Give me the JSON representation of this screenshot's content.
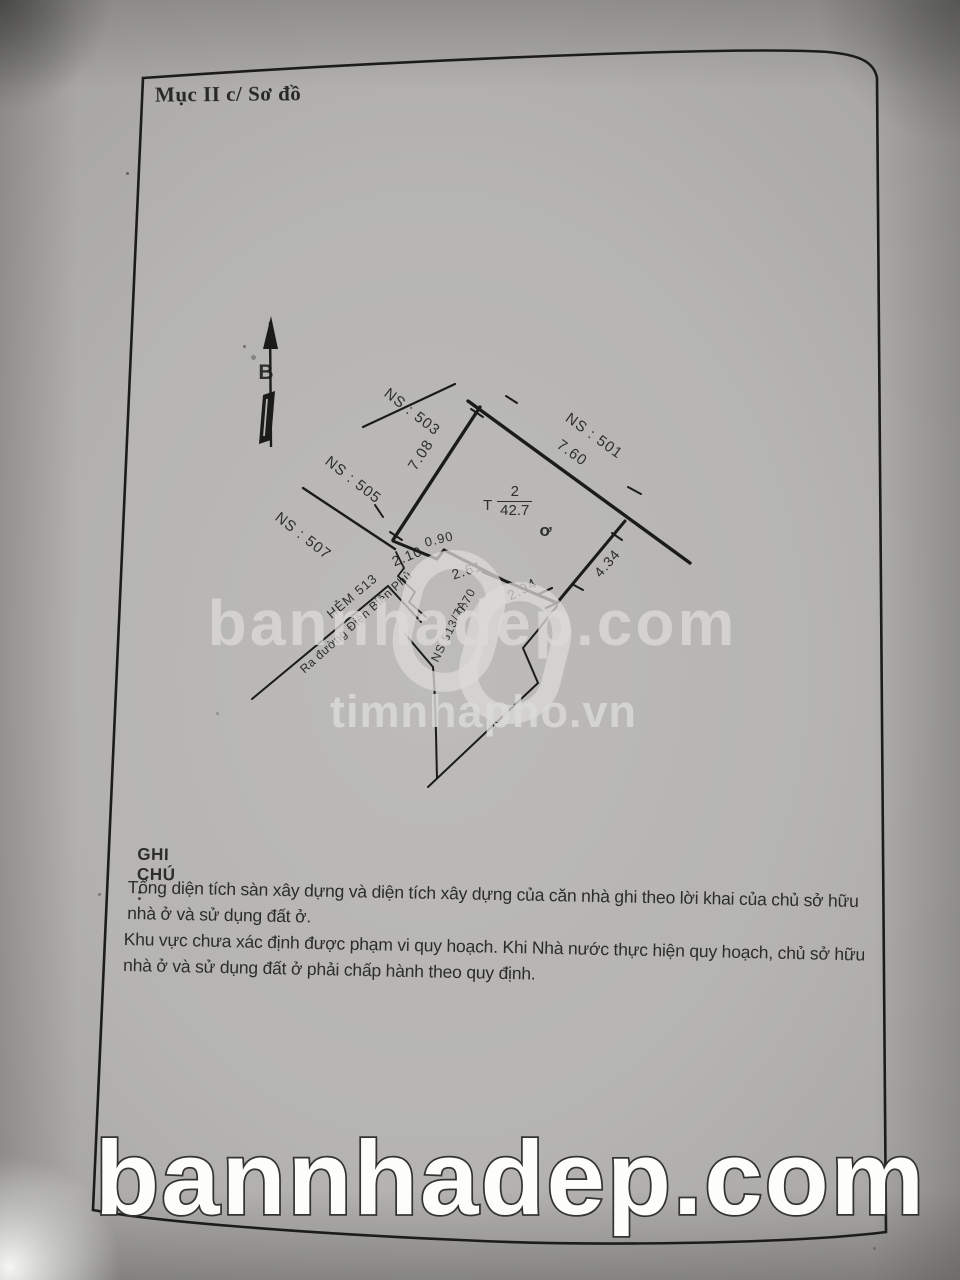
{
  "page": {
    "section_title": "Mục II c/ Sơ đồ",
    "compass_label": "B"
  },
  "sketch": {
    "parcels": {
      "p503": "NS : 503",
      "p505": "NS : 505",
      "p507": "NS : 507",
      "p501": "NS : 501"
    },
    "dims": {
      "d708": "7.08",
      "d760": "7.60",
      "d090": "0.90",
      "d210": "2.10",
      "d261": "2.61",
      "d294": "2.94",
      "d070": "0.70",
      "d434": "4.34"
    },
    "plot": {
      "prefix": "T",
      "floors": "2",
      "area": "42.7",
      "marker": "ơ"
    },
    "streets": {
      "hem": "HẺM 513",
      "ra_duong": "Ra đường Điện Biên Phủ",
      "ns_alley": "NS 513/7A"
    }
  },
  "notes": {
    "heading": "GHI CHÚ :",
    "paragraphs": [
      "Tổng diện tích sàn xây dựng và diện tích xây dựng của căn nhà ghi theo lời khai của chủ sở hữu nhà ở và sử dụng đất ở.",
      "Khu vực chưa xác định được phạm vi quy hoạch. Khi Nhà nước thực hiện quy hoạch, chủ sở hữu nhà ở và sử dụng đất ở phải chấp hành theo quy định."
    ]
  },
  "watermarks": {
    "center_text": "bannhadep.com",
    "center_sub": "timnhapho.vn",
    "bottom_text": "bannhadep.com"
  },
  "colors": {
    "paper": "#b2b1af",
    "ink": "#21211f",
    "watermark": "#d6d5d2"
  }
}
